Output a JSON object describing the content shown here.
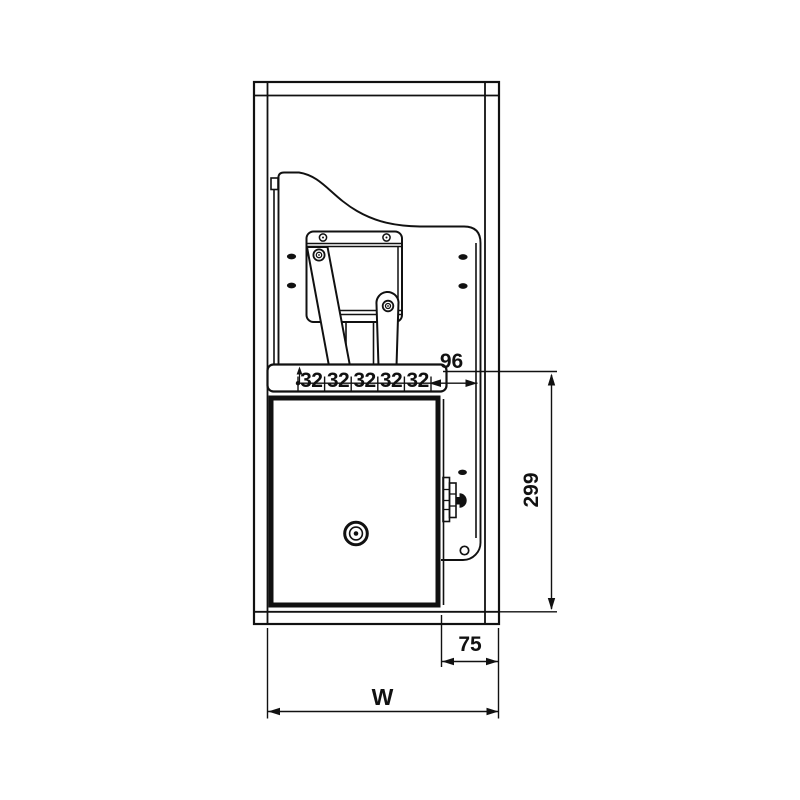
{
  "diagram": {
    "type": "technical-drawing",
    "background": "#ffffff",
    "line_color": "#111111",
    "labels": {
      "hole_pitch": [
        "32",
        "32",
        "32",
        "32",
        "32"
      ],
      "rail_end_offset": "96",
      "drop_height": "299",
      "side_clearance": "75",
      "cabinet_width": "W"
    }
  }
}
